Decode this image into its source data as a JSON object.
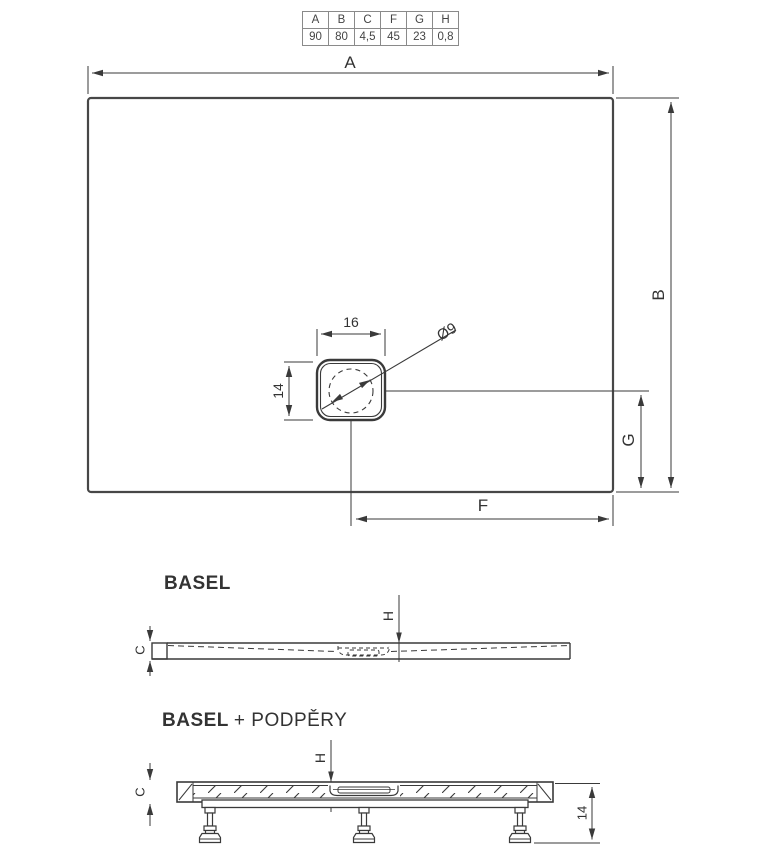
{
  "colors": {
    "line": "#3a3a3a",
    "outline": "#474747",
    "text": "#333333",
    "background": "#ffffff"
  },
  "table": {
    "headers": [
      "A",
      "B",
      "C",
      "F",
      "G",
      "H"
    ],
    "values": [
      "90",
      "80",
      "4,5",
      "45",
      "23",
      "0,8"
    ]
  },
  "plan_view": {
    "dim_a": "A",
    "dim_b": "B",
    "dim_g": "G",
    "dim_f": "F",
    "drain_width": "16",
    "drain_depth": "14",
    "drain_diameter": "Ø9"
  },
  "side_view": {
    "title": "BASEL",
    "dim_c": "C",
    "dim_h": "H"
  },
  "support_view": {
    "title_brand": "BASEL",
    "title_suffix": "+ PODPĚRY",
    "dim_c": "C",
    "dim_h": "H",
    "dim_leg_height": "14"
  }
}
